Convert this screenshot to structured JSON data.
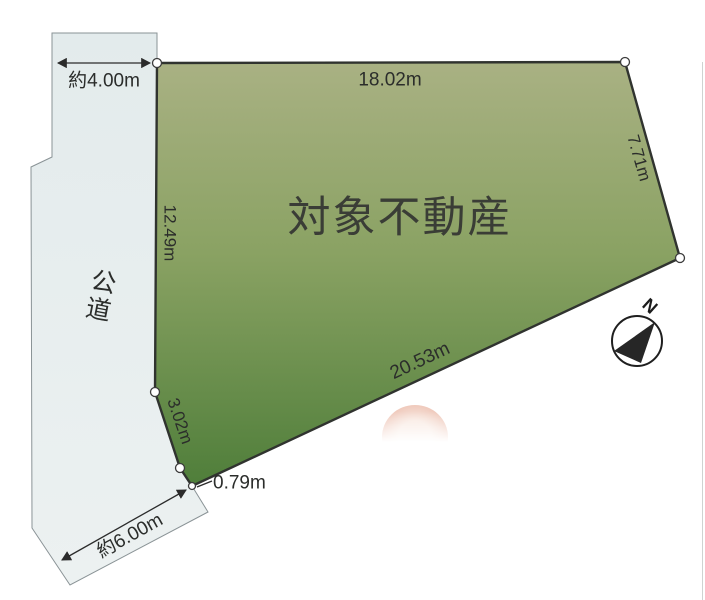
{
  "figure": {
    "type": "land-plot-diagram",
    "parcel_label": "対象不動産",
    "road_label": "公道",
    "compass_label": "N",
    "dimensions": {
      "road_width_top": "約4.00m",
      "road_width_bottom": "約6.00m",
      "edge_top": "18.02m",
      "edge_right": "7.71m",
      "edge_bottom": "20.53m",
      "edge_left": "12.49m",
      "edge_lower_left": "3.02m",
      "edge_notch": "0.79m"
    },
    "colors": {
      "parcel_gradient_top": "#a9b183",
      "parcel_gradient_mid": "#8aa263",
      "parcel_gradient_bottom": "#4f7e3a",
      "road_fill": "#e3ebec",
      "road_fill_light": "#ecf1f1",
      "outline_dark": "#30332f",
      "road_outline": "#8a9396",
      "stamp_pink": "#eec4b5",
      "stamp_pink_light": "#f8e7de"
    }
  }
}
